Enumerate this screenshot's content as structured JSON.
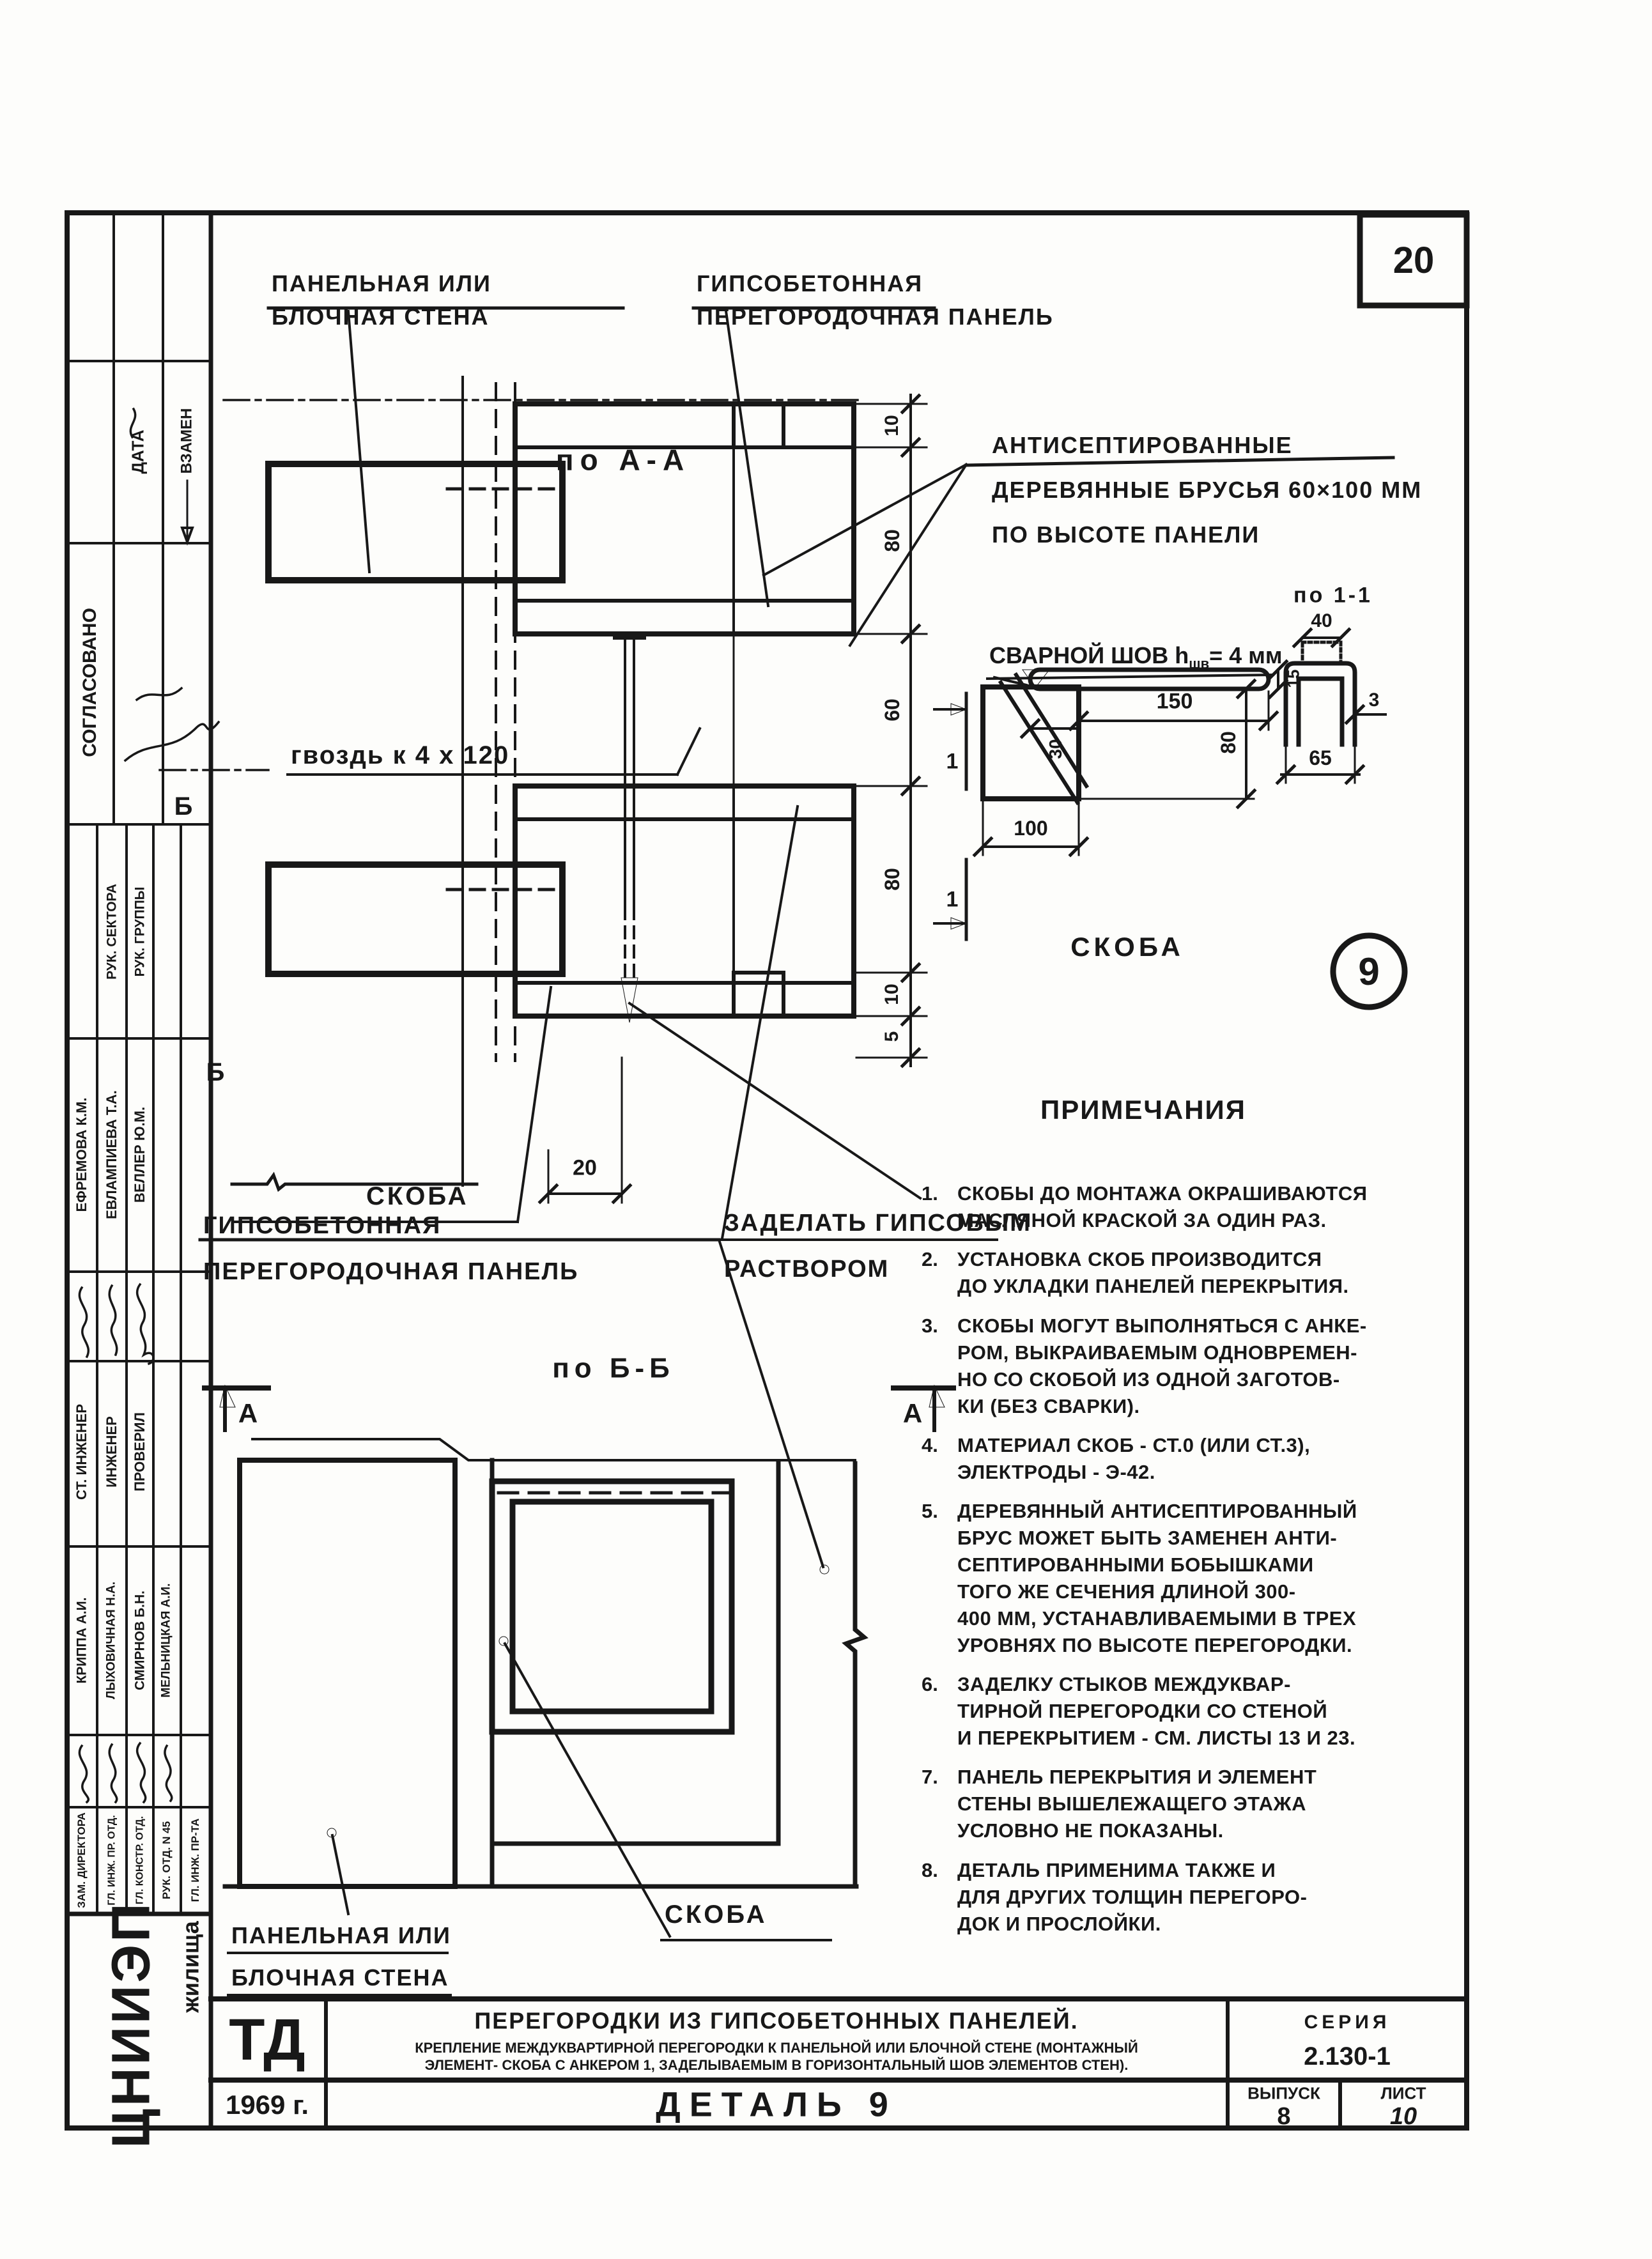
{
  "page": {
    "number": "20"
  },
  "sidebar": {
    "date_label": "ДАТА",
    "replacement_label": "ВЗАМЕН",
    "approved_label": "СОГЛАСОВАНО",
    "approval_titles": {
      "sector": "РУК. СЕКТОРА",
      "group": "РУК. ГРУППЫ"
    },
    "approval_names": {
      "n1": "ЕФРЕМОВА К.М.",
      "n2": "ЕВЛАМПИЕВА Т.А.",
      "n3": "ВЕЛЛЕР Ю.М."
    },
    "role_titles": {
      "t1": "СТ. ИНЖЕНЕР",
      "t2": "ИНЖЕНЕР",
      "t3": "ПРОВЕРИЛ"
    },
    "role_names": {
      "n1": "КРИППА А.И.",
      "n2": "ЛЫХОВИЧНАЯ Н.А.",
      "n3": "СМИРНОВ Б.Н.",
      "n4": "МЕЛЬНИЦКАЯ А.И."
    },
    "job_titles": {
      "j1": "ЗАМ. ДИРЕКТОРА",
      "j2": "ГЛ. ИНЖ. ПР. ОТД.",
      "j3": "ГЛ. КОНСТР. ОТД.",
      "j4": "РУК. ОТД. N 45",
      "j5": "ГЛ. ИНЖ. ПР-ТА"
    }
  },
  "drawing_aa": {
    "title": "по А-А",
    "wall_label": "ПАНЕЛЬНАЯ ИЛИ\nБЛОЧНАЯ СТЕНА",
    "panel_label": "ГИПСОБЕТОННАЯ\nПЕРЕГОРОДОЧНАЯ ПАНЕЛЬ",
    "brus_label": "АНТИСЕПТИРОВАННЫЕ\nДЕРЕВЯННЫЕ БРУСЬЯ 60×100 ММ\nПО ВЫСОТЕ ПАНЕЛИ",
    "nail_label": "гвоздь к 4 х 120",
    "skoba_label": "СКОБА",
    "mortar_label": "ЗАДЕЛАТЬ ГИПСОВЫМ\nРАСТВОРОМ",
    "section_b_mark": "Б",
    "dims": {
      "d10t": "10",
      "d80t": "80",
      "d60": "60",
      "d80b": "80",
      "d10b": "10",
      "d5": "5",
      "d20": "20"
    }
  },
  "skoba_detail": {
    "weld_label_pre": "СВАРНОЙ ШОВ h",
    "weld_label_sub": "шв",
    "weld_label_post": "= 4 мм",
    "section_title": "по 1-1",
    "section_mark": "1",
    "name_label": "СКОБА",
    "detail_badge": "9",
    "dims": {
      "d150": "150",
      "d30": "30",
      "d100": "100",
      "d80": "80",
      "d15": "15",
      "d40": "40",
      "d3": "3",
      "d65": "65"
    }
  },
  "drawing_bb": {
    "title": "по Б-Б",
    "panel_label": "ГИПСОБЕТОННАЯ\nПЕРЕГОРОДОЧНАЯ ПАНЕЛЬ",
    "wall_label": "ПАНЕЛЬНАЯ ИЛИ\nБЛОЧНАЯ СТЕНА",
    "skoba_label": "СКОБА",
    "section_a_mark": "А"
  },
  "notes": {
    "header": "ПРИМЕЧАНИЯ",
    "items": [
      {
        "num": "1.",
        "text": "СКОБЫ ДО МОНТАЖА ОКРАШИВАЮТСЯ\nМАСЛЯНОЙ КРАСКОЙ ЗА ОДИН РАЗ."
      },
      {
        "num": "2.",
        "text": "УСТАНОВКА СКОБ ПРОИЗВОДИТСЯ\nДО УКЛАДКИ ПАНЕЛЕЙ ПЕРЕКРЫТИЯ."
      },
      {
        "num": "3.",
        "text": "СКОБЫ МОГУТ ВЫПОЛНЯТЬСЯ С АНКЕ-\nРОМ, ВЫКРАИВАЕМЫМ ОДНОВРЕМЕН-\nНО СО СКОБОЙ ИЗ ОДНОЙ ЗАГОТОВ-\nКИ (БЕЗ СВАРКИ)."
      },
      {
        "num": "4.",
        "text": "МАТЕРИАЛ СКОБ - СТ.0 (ИЛИ СТ.3),\nЭЛЕКТРОДЫ - Э-42."
      },
      {
        "num": "5.",
        "text": "ДЕРЕВЯННЫЙ АНТИСЕПТИРОВАННЫЙ\nБРУС МОЖЕТ БЫТЬ ЗАМЕНЕН АНТИ-\nСЕПТИРОВАННЫМИ БОБЫШКАМИ\nТОГО ЖЕ СЕЧЕНИЯ ДЛИНОЙ 300-\n400 ММ, УСТАНАВЛИВАЕМЫМИ В ТРЕХ\nУРОВНЯХ ПО ВЫСОТЕ ПЕРЕГОРОДКИ."
      },
      {
        "num": "6.",
        "text": "ЗАДЕЛКУ СТЫКОВ МЕЖДУКВАР-\nТИРНОЙ ПЕРЕГОРОДКИ СО СТЕНОЙ\nИ ПЕРЕКРЫТИЕМ - СМ. ЛИСТЫ 13 И 23."
      },
      {
        "num": "7.",
        "text": "ПАНЕЛЬ ПЕРЕКРЫТИЯ И ЭЛЕМЕНТ\nСТЕНЫ ВЫШЕЛЕЖАЩЕГО ЭТАЖА\nУСЛОВНО НЕ ПОКАЗАНЫ."
      },
      {
        "num": "8.",
        "text": "ДЕТАЛЬ ПРИМЕНИМА ТАКЖЕ И\nДЛЯ ДРУГИХ ТОЛЩИН ПЕРЕГОРО-\nДОК И ПРОСЛОЙКИ."
      }
    ]
  },
  "titleblock": {
    "org_code": "ТД",
    "title": "ПЕРЕГОРОДКИ ИЗ ГИПСОБЕТОННЫХ ПАНЕЛЕЙ.",
    "subtitle": "КРЕПЛЕНИЕ МЕЖДУКВАРТИРНОЙ ПЕРЕГОРОДКИ К ПАНЕЛЬНОЙ ИЛИ БЛОЧНОЙ СТЕНЕ (МОНТАЖНЫЙ\nЭЛЕМЕНТ- СКОБА С АНКЕРОМ 1, ЗАДЕЛЫВАЕМЫМ В ГОРИЗОНТАЛЬНЫЙ ШОВ ЭЛЕМЕНТОВ СТЕН).",
    "series_label": "СЕРИЯ",
    "series_value": "2.130-1",
    "year": "1969 г.",
    "detail": "ДЕТАЛЬ 9",
    "issue_label": "ВЫПУСК",
    "issue_value": "8",
    "sheet_label": "ЛИСТ",
    "sheet_value": "10",
    "org_logo": "ЦНИИЭП",
    "org_logo_sub": "жилища"
  }
}
